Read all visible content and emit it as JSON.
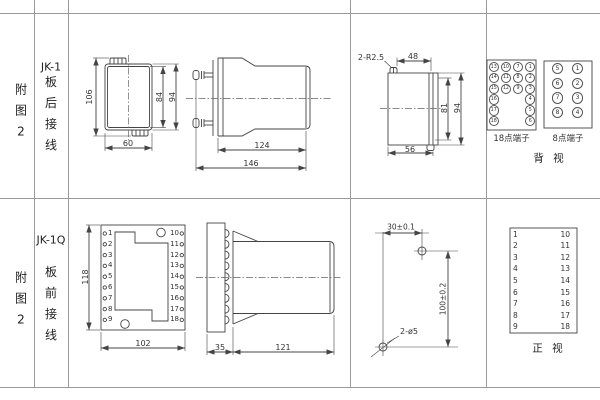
{
  "sheet": {
    "row_top": {
      "figure": {
        "c1": "附",
        "c2": "图",
        "c3": "2"
      },
      "model": "JK-1",
      "wiring": {
        "c1": "板",
        "c2": "后",
        "c3": "接",
        "c4": "线"
      },
      "front_view": {
        "dim_total_height": "106",
        "dim_inner_height": "84",
        "dim_outer_height": "94",
        "dim_width": "60"
      },
      "side_view": {
        "dim_body": "124",
        "dim_total": "146"
      },
      "rear_view": {
        "corner_label": "2-R2.5",
        "dim_top": "48",
        "dim_inner_height": "81",
        "dim_outer_height": "94",
        "dim_bottom": "56"
      },
      "terminals_18": {
        "label": "18点端子",
        "cells": [
          "13",
          "10",
          "7",
          "1",
          "14",
          "11",
          "8",
          "2",
          "15",
          "12",
          "9",
          "3",
          "16",
          "",
          "",
          "4",
          "17",
          "",
          "",
          "5",
          "18",
          "",
          "",
          "6"
        ]
      },
      "terminals_8": {
        "label": "8点端子",
        "cells": [
          "5",
          "1",
          "6",
          "2",
          "7",
          "3",
          "8",
          "4"
        ]
      },
      "view_label": "背 视"
    },
    "row_bottom": {
      "figure": {
        "c1": "附",
        "c2": "图",
        "c3": "2"
      },
      "model": "JK-1Q",
      "wiring": {
        "c1": "板",
        "c2": "前",
        "c3": "接",
        "c4": "线"
      },
      "front_view": {
        "dim_height": "118",
        "dim_width": "102",
        "left_terminals": [
          "1",
          "2",
          "3",
          "4",
          "5",
          "6",
          "7",
          "8",
          "9"
        ],
        "right_terminals": [
          "10",
          "11",
          "12",
          "13",
          "14",
          "15",
          "16",
          "17",
          "18"
        ]
      },
      "side_view": {
        "dim_plate": "35",
        "dim_body": "121"
      },
      "drill_view": {
        "dim_horizontal": "30±0.1",
        "dim_vertical": "100±0.2",
        "hole_label": "2-ø5"
      },
      "terminal_table": {
        "left": [
          "1",
          "2",
          "3",
          "4",
          "5",
          "6",
          "7",
          "8",
          "9"
        ],
        "right": [
          "10",
          "11",
          "12",
          "13",
          "14",
          "15",
          "16",
          "17",
          "18"
        ]
      },
      "view_label": "正 视"
    }
  }
}
